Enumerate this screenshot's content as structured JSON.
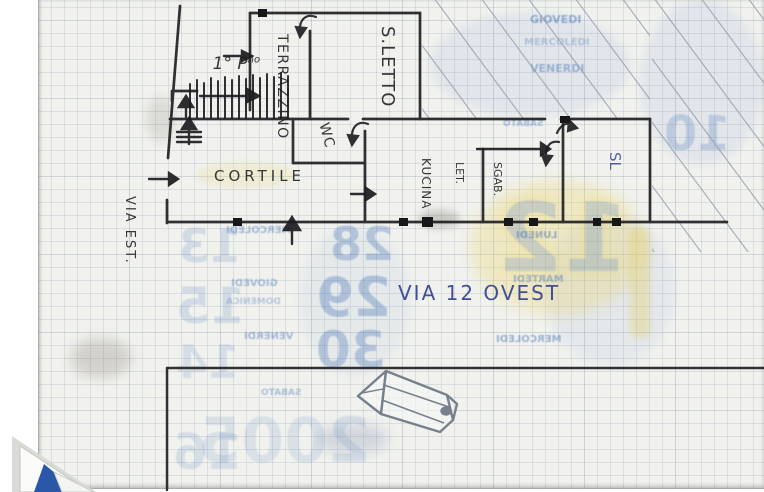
{
  "plan": {
    "labels": {
      "floor_prefix": "1° P",
      "floor_sup": "no",
      "terrace": "TERRAZZINO",
      "bedroom": "S.LETTO",
      "wc": "WC",
      "courtyard": "CORTILE",
      "kitchen": "KUCINA",
      "closet_line1": "SGAB.",
      "closet_line2": "LET.",
      "room_sl": "SL",
      "street_left": "VIA EST.",
      "street_bottom": "VIA 12 OVEST"
    },
    "ink_color": "#1d1d20",
    "pen_blue": "#2c3a8c",
    "pencil_gray": "#98a0ad"
  },
  "background": {
    "ghosts": [
      {
        "text": "GIOVEDI",
        "x": 530,
        "y": 14,
        "size": 11,
        "o": 0.5,
        "flip": false
      },
      {
        "text": "MERCOLEDI",
        "x": 524,
        "y": 38,
        "size": 10,
        "o": 0.32,
        "flip": false
      },
      {
        "text": "VENERDI",
        "x": 530,
        "y": 63,
        "size": 11,
        "o": 0.45,
        "flip": false
      },
      {
        "text": "SABATO",
        "x": 503,
        "y": 120,
        "size": 9,
        "o": 0.42,
        "flip": true
      },
      {
        "text": "LUNEDI",
        "x": 516,
        "y": 231,
        "size": 10,
        "o": 0.5,
        "flip": true
      },
      {
        "text": "MARTEDI",
        "x": 513,
        "y": 275,
        "size": 10,
        "o": 0.45,
        "flip": true
      },
      {
        "text": "MERCOLEDI",
        "x": 496,
        "y": 335,
        "size": 10,
        "o": 0.48,
        "flip": true
      },
      {
        "text": "MERCOLEDI",
        "x": 226,
        "y": 226,
        "size": 10,
        "o": 0.42,
        "flip": true
      },
      {
        "text": "GIOVEDI",
        "x": 231,
        "y": 279,
        "size": 10,
        "o": 0.42,
        "flip": true
      },
      {
        "text": "DOMENICA",
        "x": 226,
        "y": 298,
        "size": 9,
        "o": 0.32,
        "flip": true
      },
      {
        "text": "VENERDI",
        "x": 244,
        "y": 332,
        "size": 10,
        "o": 0.42,
        "flip": true
      },
      {
        "text": "SABATO",
        "x": 261,
        "y": 389,
        "size": 9,
        "o": 0.38,
        "flip": true
      },
      {
        "text": "28",
        "x": 330,
        "y": 221,
        "size": 46,
        "o": 0.3,
        "flip": true
      },
      {
        "text": "29",
        "x": 316,
        "y": 271,
        "size": 54,
        "o": 0.32,
        "flip": true
      },
      {
        "text": "30",
        "x": 316,
        "y": 325,
        "size": 50,
        "o": 0.3,
        "flip": true
      },
      {
        "text": "13",
        "x": 178,
        "y": 223,
        "size": 46,
        "o": 0.17,
        "flip": true
      },
      {
        "text": "15",
        "x": 176,
        "y": 281,
        "size": 50,
        "o": 0.17,
        "flip": true
      },
      {
        "text": "14",
        "x": 176,
        "y": 339,
        "size": 46,
        "o": 0.14,
        "flip": true
      },
      {
        "text": "16",
        "x": 173,
        "y": 427,
        "size": 50,
        "o": 0.14,
        "flip": true
      },
      {
        "text": "12",
        "x": 497,
        "y": 192,
        "size": 95,
        "o": 0.2,
        "flip": true,
        "yellow": true
      },
      {
        "text": "10",
        "x": 664,
        "y": 110,
        "size": 48,
        "o": 0.22,
        "flip": true
      },
      {
        "text": "2005",
        "x": 198,
        "y": 410,
        "size": 62,
        "o": 0.12,
        "flip": true
      }
    ]
  }
}
